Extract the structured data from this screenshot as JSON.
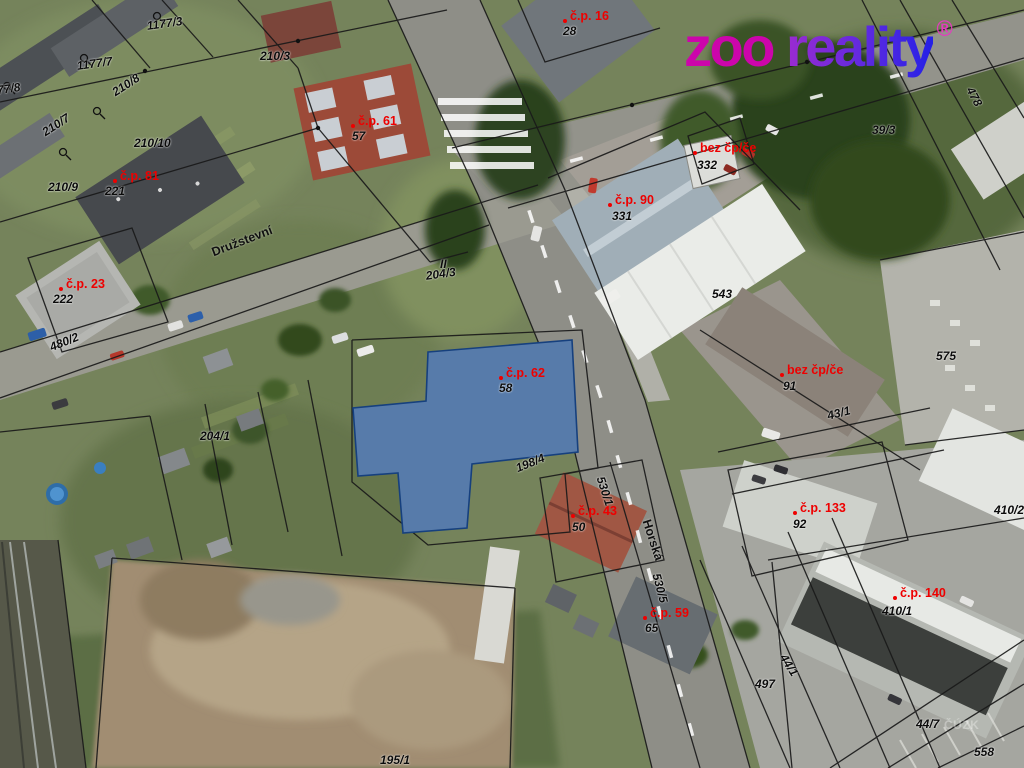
{
  "logo": {
    "zoo": "zoo ",
    "reality": "reality",
    "registered": "®",
    "color_zoo": "#cc05ab",
    "color_reality_start": "#9b2bd0",
    "color_reality_end": "#2420e6"
  },
  "watermark": {
    "text": "ČÚZK"
  },
  "map": {
    "highlight_color": "#3a76c4",
    "house_label_color": "#ee0000",
    "parcel_label_color": "#000000",
    "building_labels": [
      {
        "cp": "č.p. 16",
        "x": 570,
        "y": 10,
        "sub": "28",
        "sx": 563,
        "sy": 25
      },
      {
        "cp": "č.p. 61",
        "x": 358,
        "y": 115,
        "sub": "57",
        "sx": 352,
        "sy": 130
      },
      {
        "cp": "č.p. 81",
        "x": 120,
        "y": 170,
        "sub": "221",
        "sx": 105,
        "sy": 185
      },
      {
        "cp": "č.p. 23",
        "x": 66,
        "y": 278,
        "sub": "222",
        "sx": 53,
        "sy": 293
      },
      {
        "cp": "č.p. 90",
        "x": 615,
        "y": 194,
        "sub": "331",
        "sx": 612,
        "sy": 210
      },
      {
        "cp": "bez čp/če",
        "x": 700,
        "y": 142,
        "sub": "332",
        "sx": 697,
        "sy": 159
      },
      {
        "cp": "bez čp/če",
        "x": 787,
        "y": 364,
        "sub": "91",
        "sx": 783,
        "sy": 380
      },
      {
        "cp": "č.p. 62",
        "x": 506,
        "y": 367,
        "sub": "58",
        "sx": 499,
        "sy": 382
      },
      {
        "cp": "č.p. 43",
        "x": 578,
        "y": 505,
        "sub": "50",
        "sx": 572,
        "sy": 521
      },
      {
        "cp": "č.p. 59",
        "x": 650,
        "y": 607,
        "sub": "65",
        "sx": 645,
        "sy": 622
      },
      {
        "cp": "č.p. 133",
        "x": 800,
        "y": 502,
        "sub": "92",
        "sx": 793,
        "sy": 518
      },
      {
        "cp": "č.p. 140",
        "x": 900,
        "y": 587,
        "sub": "410/1",
        "sx": 882,
        "sy": 605
      }
    ],
    "parcel_labels": [
      {
        "t": "1177/3",
        "x": 146,
        "y": 20,
        "r": -8
      },
      {
        "t": "1177/7",
        "x": 76,
        "y": 60,
        "r": -8
      },
      {
        "t": "1177/8",
        "x": -16,
        "y": 86,
        "r": -8
      },
      {
        "t": "210/3",
        "x": 260,
        "y": 50,
        "r": 0
      },
      {
        "t": "210/8",
        "x": 110,
        "y": 88,
        "r": -33
      },
      {
        "t": "210/7",
        "x": 40,
        "y": 128,
        "r": -33
      },
      {
        "t": "210/10",
        "x": 134,
        "y": 137,
        "r": 0
      },
      {
        "t": "210/9",
        "x": 48,
        "y": 181,
        "r": 0
      },
      {
        "t": "39/3",
        "x": 872,
        "y": 124,
        "r": 0
      },
      {
        "t": "478",
        "x": 975,
        "y": 85,
        "r": 62
      },
      {
        "t": "543",
        "x": 712,
        "y": 288,
        "r": 0
      },
      {
        "t": "575",
        "x": 936,
        "y": 350,
        "r": 0
      },
      {
        "t": "43/1",
        "x": 826,
        "y": 410,
        "r": -14
      },
      {
        "t": "480/2",
        "x": 48,
        "y": 342,
        "r": -22
      },
      {
        "t": "204/3",
        "x": 425,
        "y": 270,
        "r": -8
      },
      {
        "t": "II",
        "x": 440,
        "y": 258,
        "r": 0
      },
      {
        "t": "204/1",
        "x": 200,
        "y": 430,
        "r": 0
      },
      {
        "t": "198/4",
        "x": 514,
        "y": 463,
        "r": -22
      },
      {
        "t": "530/1",
        "x": 606,
        "y": 475,
        "r": 72
      },
      {
        "t": "530/5",
        "x": 662,
        "y": 572,
        "r": 75
      },
      {
        "t": "497",
        "x": 755,
        "y": 678,
        "r": 0
      },
      {
        "t": "44/1",
        "x": 788,
        "y": 652,
        "r": 58
      },
      {
        "t": "44/7",
        "x": 916,
        "y": 718,
        "r": 0
      },
      {
        "t": "558",
        "x": 974,
        "y": 746,
        "r": 0
      },
      {
        "t": "410/2",
        "x": 994,
        "y": 504,
        "r": 0
      },
      {
        "t": "195/1",
        "x": 380,
        "y": 754,
        "r": 0
      }
    ],
    "street_labels": [
      {
        "t": "Družstevní",
        "x": 210,
        "y": 247,
        "r": -21
      },
      {
        "t": "Horská",
        "x": 652,
        "y": 518,
        "r": 72
      }
    ]
  }
}
